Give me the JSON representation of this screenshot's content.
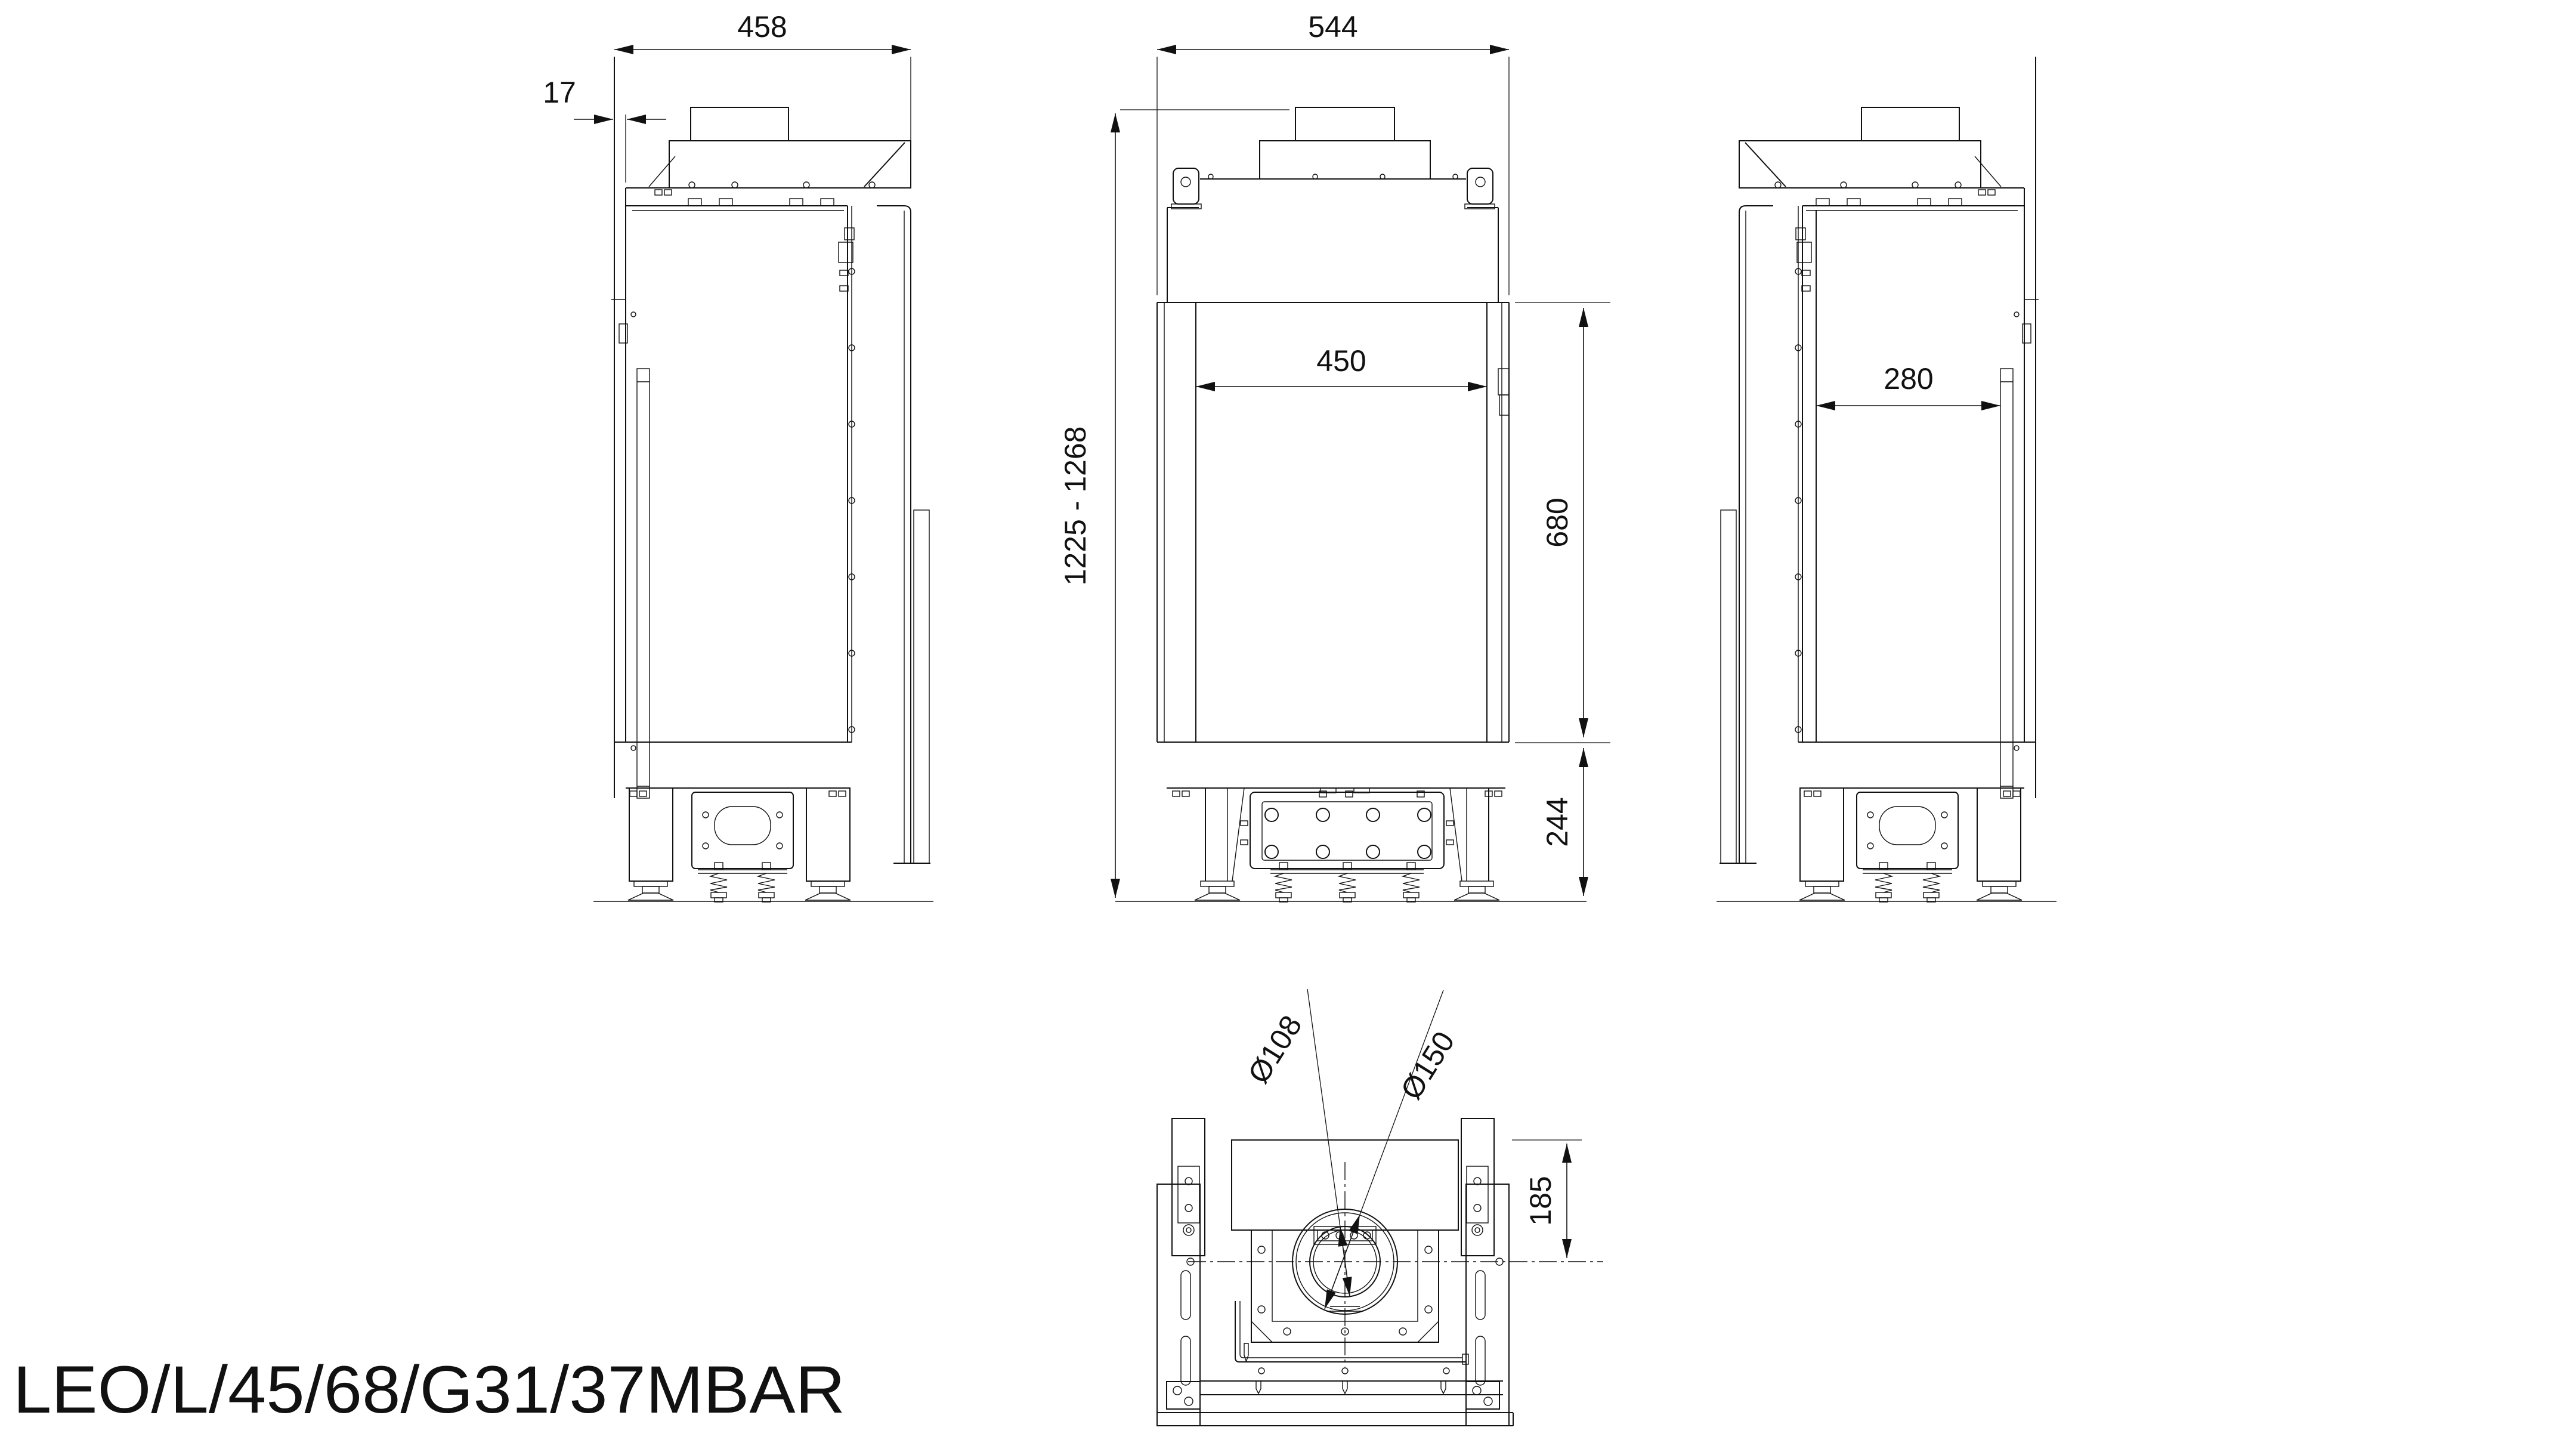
{
  "title": "LEO/L/45/68/G31/37MBAR",
  "dimensions": {
    "depth": "458",
    "glass_front_offset": "17",
    "width": "544",
    "glass_opening_width": "450",
    "glass_opening_height": "680",
    "overall_height_range": "1225 - 1268",
    "base_height": "244",
    "side_glass_width": "280",
    "flue_inner_diameter": "Ø108",
    "flue_outer_diameter": "Ø150",
    "flue_center_from_rear": "185"
  }
}
